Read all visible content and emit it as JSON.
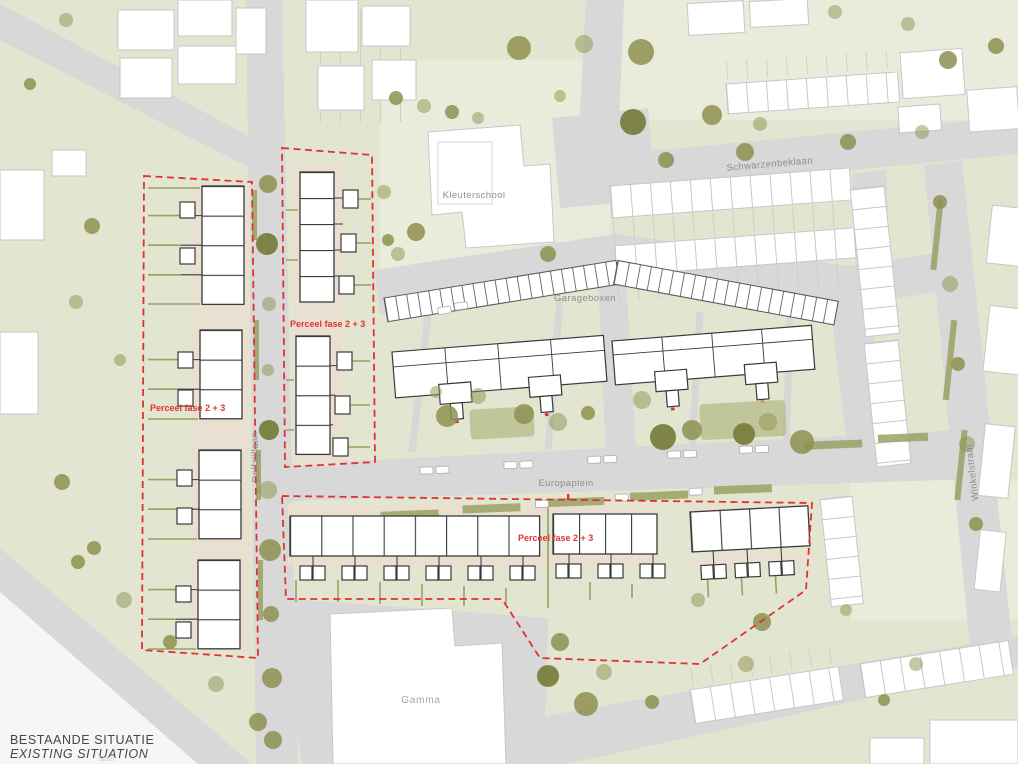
{
  "plan": {
    "title": "BESTAANDE SITUATIE",
    "subtitle": "EXISTING SITUATION",
    "watermark": "Sport"
  },
  "streets": {
    "schwarzenbeklaan": "Schwarzenbeklaan",
    "delfzijllaan": "Delfzijllaan",
    "europaplein": "Europaplein",
    "winkelstraat": "Winkelstraat"
  },
  "buildings": {
    "kleuterschool": "Kleuterschool",
    "garageboxen": "Garageboxen",
    "gamma": "Gamma"
  },
  "parcels": {
    "label": "Perceel fase 2 + 3",
    "count": 3,
    "outline_style": "dashed"
  },
  "palette": {
    "map_green": "#e2e5d0",
    "map_green_light": "#e9ecdb",
    "road_gray": "#d7d8d7",
    "building_white": "#ffffff",
    "context_outline": "#c6c8c9",
    "plan_outline": "#3a3a3a",
    "garden_beige": "#e9e0d1",
    "tree_olive": "#8e9150",
    "tree_olive_dark": "#787f3e",
    "hedge_olive": "#9aa163",
    "parcel_red": "#e03232",
    "street_label_gray": "#8d8f90",
    "title_color": "#42474a",
    "paper_white": "#f6f6f4"
  }
}
